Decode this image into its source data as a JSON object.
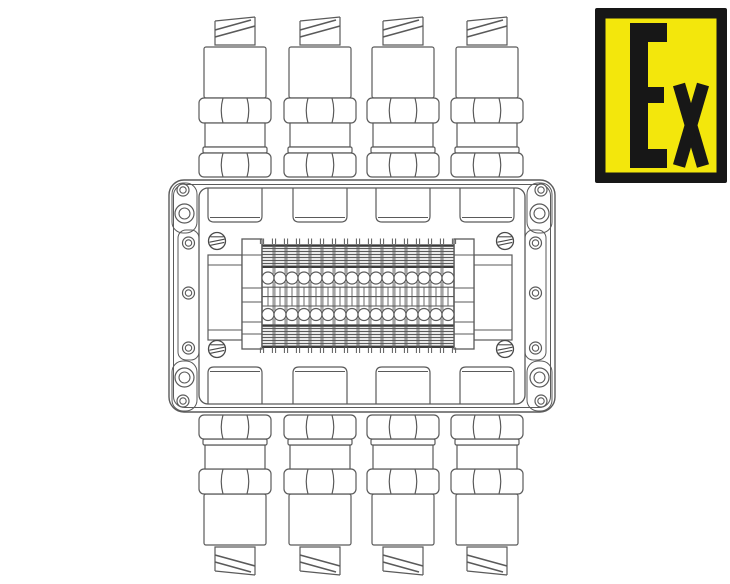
{
  "drawing": {
    "subject": "Explosion-proof terminal junction box with cable glands, top view line drawing",
    "line_color": "#5a5a5a",
    "line_color_strong": "#4a4a4a",
    "hatch_edge_color": "#3a3a3a",
    "hatch_fill": "#e9e9e9",
    "background": "#ffffff",
    "cable_glands": {
      "top": 4,
      "bottom": 4
    },
    "terminal_block": {
      "terminal_count": 16,
      "screw_rows": 2,
      "end_brackets": 2
    },
    "enclosure": {
      "cover_screws": 4,
      "small_flange_holes": 10,
      "large_flange_holes": 4,
      "entry_bosses_top": 4,
      "entry_bosses_bottom": 4
    }
  },
  "ex_label": {
    "text": "Ex",
    "background_color": "#F3E70C",
    "frame_color": "#171717",
    "text_color": "#171717"
  }
}
